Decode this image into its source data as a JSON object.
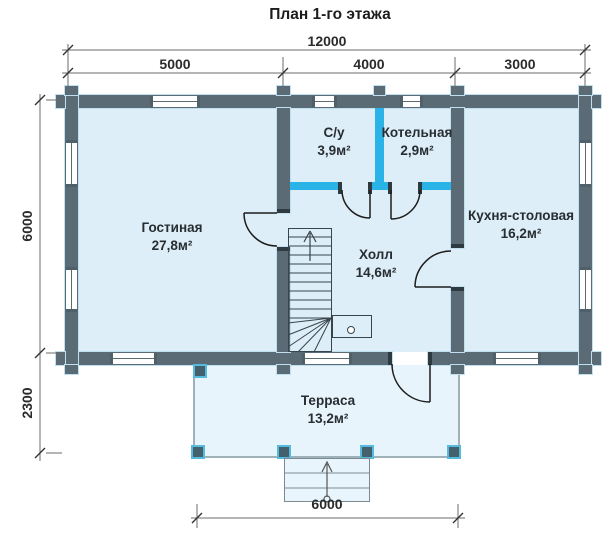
{
  "title": "План 1-го этажа",
  "dimensions": {
    "top_total": "12000",
    "top_segments": [
      "5000",
      "4000",
      "3000"
    ],
    "left_main": "6000",
    "left_terrace": "2300",
    "bottom_terrace": "6000"
  },
  "rooms": [
    {
      "name": "Гостиная",
      "area": "27,8м²"
    },
    {
      "name": "С/у",
      "area": "3,9м²"
    },
    {
      "name": "Котельная",
      "area": "2,9м²"
    },
    {
      "name": "Кухня-столовая",
      "area": "16,2м²"
    },
    {
      "name": "Холл",
      "area": "14,6м²"
    },
    {
      "name": "Терраса",
      "area": "13,2м²"
    }
  ],
  "colors": {
    "wall": "#5b6b75",
    "partition_accent": "#29b3e6",
    "room_fill": "#ddeef8",
    "terrace_fill": "#e7f4fb",
    "wall_outline": "#bfe1ef",
    "post": "#44606d",
    "post_border": "#55bade",
    "label_text": "#272d31",
    "dim_text": "#2b2b2b"
  }
}
